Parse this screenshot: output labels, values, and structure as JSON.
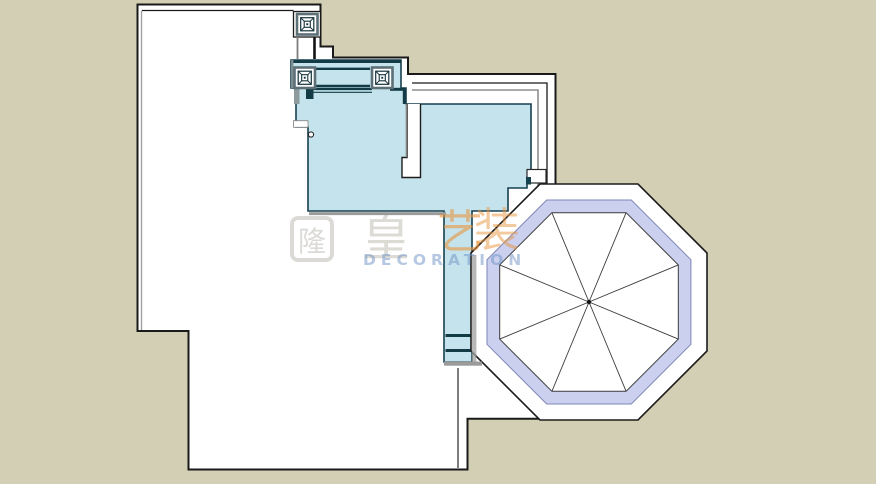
{
  "canvas": {
    "width": 876,
    "height": 484
  },
  "colors": {
    "background_tan": "#d2cfb4",
    "building_fill": "#ffffff",
    "outline_dark": "#1a1a1a",
    "room_fill": "#c5e3ec",
    "wall_teal": "#123b46",
    "shadow_gray": "#9b9b9b",
    "octagon_fill": "#ffffff",
    "octagon_band": "#cbd0ef"
  },
  "watermark": {
    "logo_char": "隆",
    "char_1": "皇",
    "char_2": "艺",
    "char_3": "装",
    "latin_text": "DECORATION",
    "orange": "#e8943d",
    "blue": "#6e91c3"
  }
}
